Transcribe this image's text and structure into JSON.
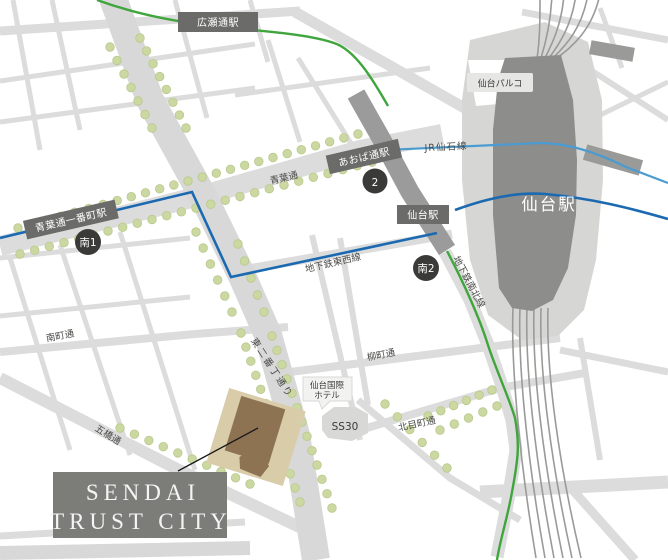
{
  "title": {
    "line1": "SENDAI",
    "line2": "TRUST CITY"
  },
  "stations": {
    "hirosedori": "広瀬通駅",
    "aobadori": "あおば通駅",
    "aobadori_ichibancho": "青葉通一番町駅",
    "sendai_subway_badge": "仙台駅",
    "sendai_band": "仙台駅",
    "sendai_building": "仙台駅"
  },
  "exits": {
    "exit2": "2",
    "minami1": "南1",
    "minami2": "南2"
  },
  "rail_lines": {
    "jr_senseki": "JR仙石線",
    "tozai": "地下鉄東西線",
    "namboku": "地下鉄南北線"
  },
  "streets": {
    "aobadori_ave": "青葉通",
    "minamimachi": "南町通",
    "yanagimachi": "柳町通",
    "higashi_nibancho": "東二番丁通り",
    "kitamemachi": "北目町通",
    "itsutsubashi": "五橋通"
  },
  "landmarks": {
    "parco": "仙台パルコ",
    "kokusai_hotel_line1": "仙台国際",
    "kokusai_hotel_line2": "ホテル",
    "ss30": "SS30"
  },
  "colors": {
    "subway_tozai_blue": "#1b6ab1",
    "jr_senseki_blue": "#4a9bd2",
    "subway_namboku_green": "#3fa53c",
    "tree_green": "#cbd8a2",
    "street_gray": "#dcdcdc",
    "rail_corridor_gray": "#9b9b9b",
    "station_building_gray": "#8d8d8b",
    "badge_gray": "#6b6b69",
    "exit_circle_dark": "#3a3a38",
    "title_box_gray": "#7c7c79",
    "site_tan": "#d9cca9",
    "building_brown": "#8d7352"
  },
  "tree_rows": [
    {
      "from": [
        110,
        47
      ],
      "to": [
        152,
        128
      ],
      "n": 7
    },
    {
      "from": [
        140,
        38
      ],
      "to": [
        186,
        128
      ],
      "n": 8
    },
    {
      "from": [
        18,
        228
      ],
      "to": [
        358,
        134
      ],
      "n": 25
    },
    {
      "from": [
        20,
        254
      ],
      "to": [
        372,
        162
      ],
      "n": 25
    },
    {
      "from": [
        196,
        232
      ],
      "to": [
        232,
        312
      ],
      "n": 6
    },
    {
      "from": [
        238,
        244
      ],
      "to": [
        264,
        312
      ],
      "n": 5
    },
    {
      "from": [
        241,
        333
      ],
      "to": [
        300,
        502
      ],
      "n": 13
    },
    {
      "from": [
        272,
        336
      ],
      "to": [
        332,
        508
      ],
      "n": 13
    },
    {
      "from": [
        120,
        428
      ],
      "to": [
        250,
        484
      ],
      "n": 10
    },
    {
      "from": [
        385,
        404
      ],
      "to": [
        447,
        468
      ],
      "n": 6
    },
    {
      "from": [
        428,
        416
      ],
      "to": [
        492,
        390
      ],
      "n": 6
    },
    {
      "from": [
        440,
        430
      ],
      "to": [
        497,
        406
      ],
      "n": 5
    }
  ]
}
